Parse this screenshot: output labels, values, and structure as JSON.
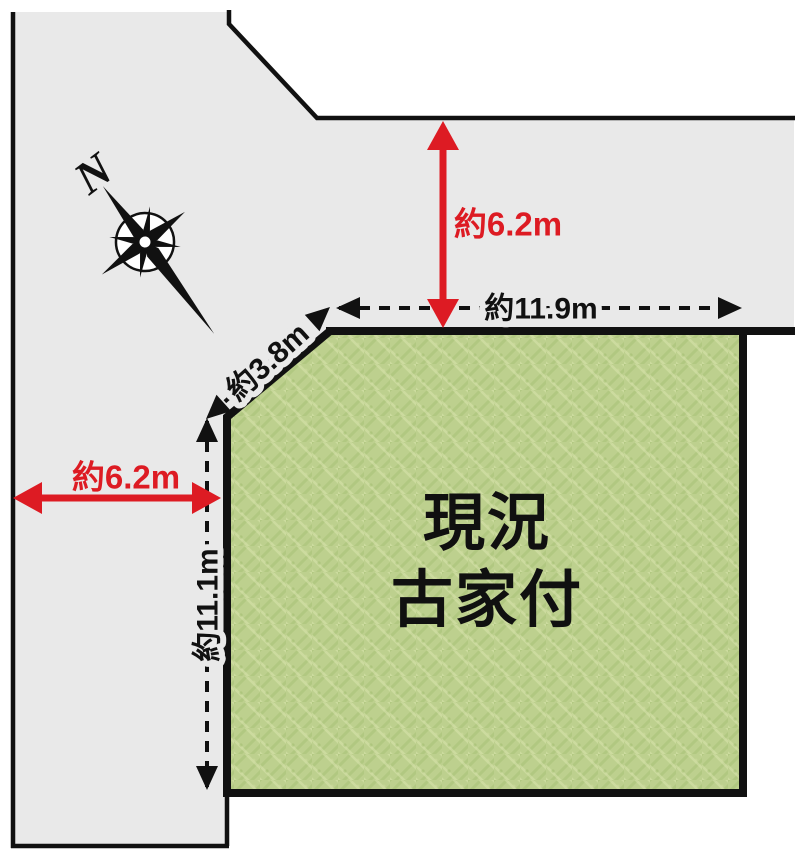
{
  "compass": {
    "north_label": "N"
  },
  "plot": {
    "status_line1": "現況",
    "status_line2": "古家付"
  },
  "measurements": {
    "road_top_width": "約6.2m",
    "road_left_width": "約6.2m",
    "edge_top": "約11.9m",
    "edge_diagonal": "約3.8m",
    "edge_left": "約11.1m"
  },
  "colors": {
    "background": "#ffffff",
    "road_gray": "#e9e9e9",
    "plot_green_base": "#bdd08e",
    "accent_red": "#dd1b23",
    "line_black": "#111111"
  }
}
